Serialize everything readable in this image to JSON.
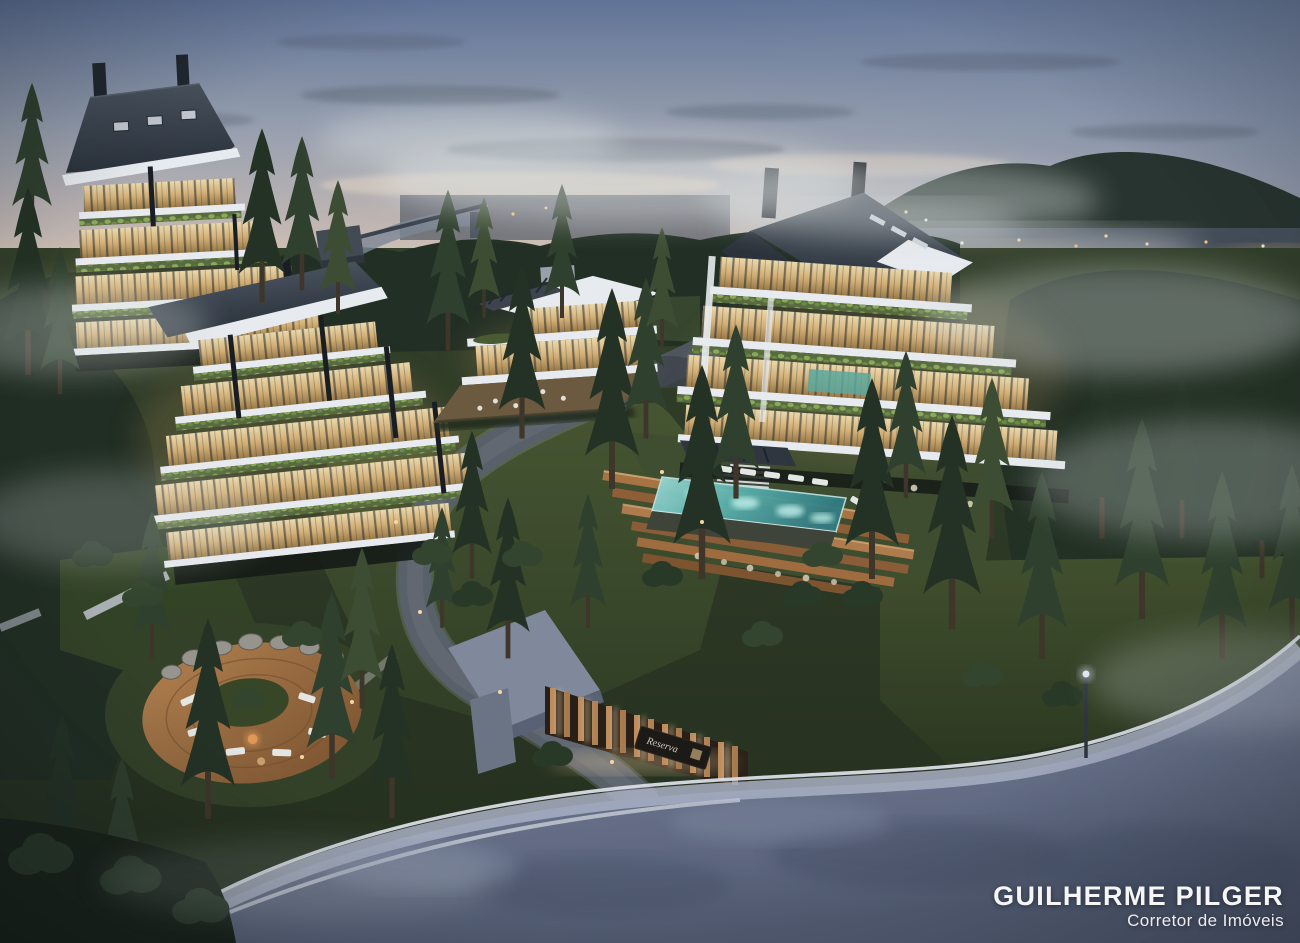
{
  "watermark": {
    "name": "GUILHERME PILGER",
    "title": "Corretor de Imóveis"
  },
  "gate": {
    "sign_text": "Reserva"
  },
  "palette": {
    "sky_top": "#5e7195",
    "sky_mid": "#98a0ae",
    "sky_horizon": "#ecd2b9",
    "mountain_dark": "#232f28",
    "forest_dark": "#1d2a1c",
    "grass_lit": "#46552c",
    "ground_dark": "#222d18",
    "roof_dark": "#2c343c",
    "slab_white": "#eceff1",
    "window_warm": "#d8b274",
    "planter_green": "#55683a",
    "pool_teal": "#56b0aa",
    "wood_deck": "#a8713d",
    "road_asphalt": "#656e84",
    "curb_light": "#c6cbd4",
    "fence_wood": "#c08c58",
    "fence_glow": "#ffdfa8",
    "city_lights": "#ffcf8e",
    "watermark_text": "#f5f5f5"
  }
}
